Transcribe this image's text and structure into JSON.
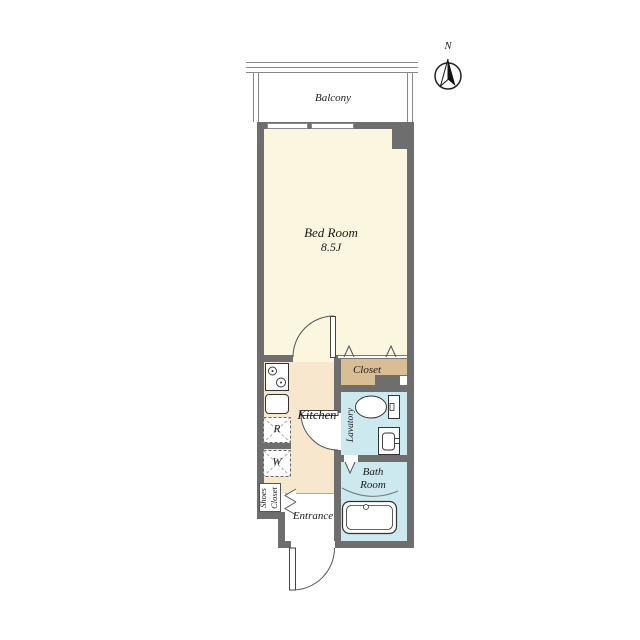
{
  "compass": {
    "north": "N"
  },
  "balcony": {
    "label": "Balcony"
  },
  "bedroom": {
    "name": "Bed Room",
    "size": "8.5J"
  },
  "closet": {
    "label": "Closet"
  },
  "kitchen": {
    "label": "Kitchen"
  },
  "lavatory": {
    "label": "Lavatory"
  },
  "bathroom": {
    "line1": "Bath",
    "line2": "Room"
  },
  "entrance": {
    "label": "Entrance"
  },
  "shoes_closet": {
    "line1": "Shoes",
    "line2": "Closet"
  },
  "appliances": {
    "refrigerator": "R",
    "washer": "W"
  },
  "colors": {
    "wall": "#6e6e6e",
    "bedroom_floor": "#faf6df",
    "kitchen_floor": "#f6e7cd",
    "closet_floor": "#d9be93",
    "wet_area_floor": "#cde9f0",
    "line": "#555555"
  }
}
